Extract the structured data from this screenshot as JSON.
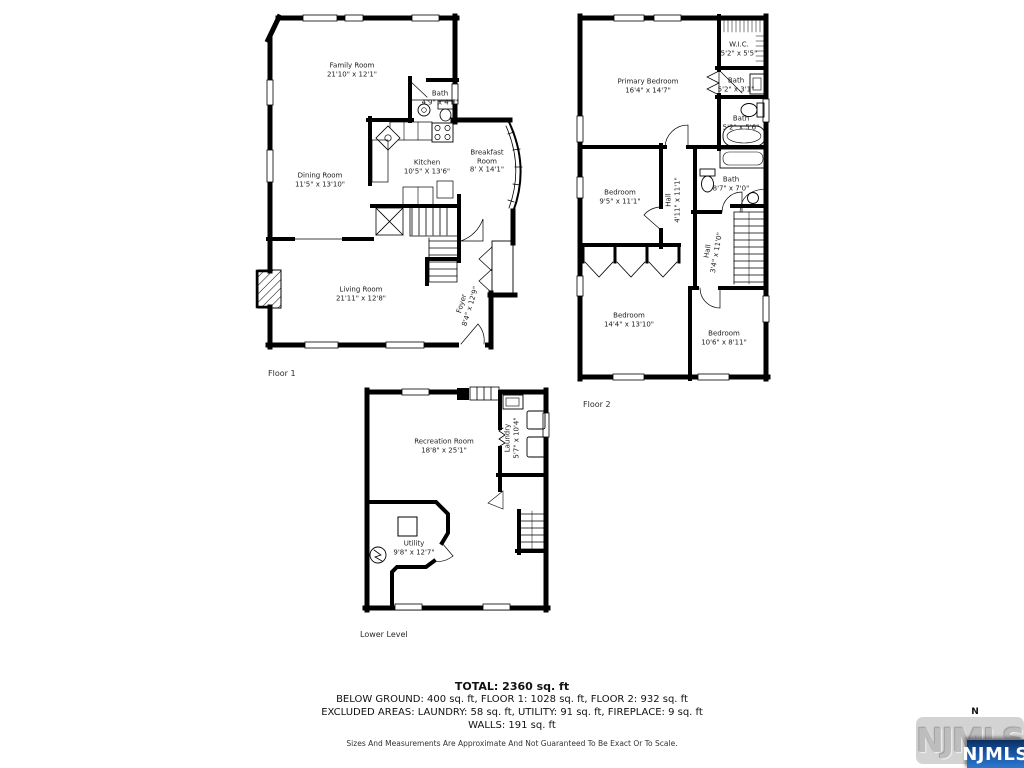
{
  "floors": {
    "floor1": {
      "label": "Floor 1",
      "rooms": {
        "family": {
          "name": "Family Room",
          "dims": "21'10\" x 12'1\""
        },
        "bath": {
          "name": "Bath",
          "dims": "4'9\" x 4'9\""
        },
        "kitchen": {
          "name": "Kitchen",
          "dims": "10'5\" X 13'6\""
        },
        "breakfast": {
          "name": "Breakfast Room",
          "dims": "8' X 14'1\""
        },
        "dining": {
          "name": "Dining Room",
          "dims": "11'5\" x 13'10\""
        },
        "living": {
          "name": "Living Room",
          "dims": "21'11\" x 12'8\""
        },
        "foyer": {
          "name": "Foyer",
          "dims": "8'4\" x 12'9\""
        }
      }
    },
    "floor2": {
      "label": "Floor 2",
      "rooms": {
        "primary": {
          "name": "Primary Bedroom",
          "dims": "16'4\" x 14'7\""
        },
        "wic": {
          "name": "W.I.C.",
          "dims": "5'2\" x 5'5\""
        },
        "bath_small": {
          "name": "Bath",
          "dims": "5'2\" x 3'1\""
        },
        "bath_mid": {
          "name": "Bath",
          "dims": "5'2\" x 5'6\""
        },
        "bedroom1": {
          "name": "Bedroom",
          "dims": "9'5\" x 11'1\""
        },
        "hall1": {
          "name": "Hall",
          "dims": "4'11\" x 11'1\""
        },
        "bath_large": {
          "name": "Bath",
          "dims": "8'7\" x 7'0\""
        },
        "hall2": {
          "name": "Hall",
          "dims": "3'4\" x 11'0\""
        },
        "bedroom2": {
          "name": "Bedroom",
          "dims": "14'4\" x 13'10\""
        },
        "bedroom3": {
          "name": "Bedroom",
          "dims": "10'6\" x 8'11\""
        }
      }
    },
    "lower": {
      "label": "Lower Level",
      "rooms": {
        "recreation": {
          "name": "Recreation Room",
          "dims": "18'8\" x 25'1\""
        },
        "laundry": {
          "name": "Laundry",
          "dims": "5'7\" x 10'4\""
        },
        "utility": {
          "name": "Utility",
          "dims": "9'8\" x 12'7\""
        }
      }
    }
  },
  "summary": {
    "total": "TOTAL: 2360 sq. ft",
    "line1": "BELOW GROUND: 400 sq. ft, FLOOR 1: 1028 sq. ft, FLOOR 2: 932 sq. ft",
    "line2": "EXCLUDED AREAS: LAUNDRY: 58 sq. ft, UTILITY: 91 sq. ft, FIREPLACE: 9 sq. ft",
    "line3": "WALLS: 191 sq. ft",
    "disclaimer": "Sizes And Measurements Are Approximate And Not Guaranteed To Be Exact Or To Scale."
  },
  "compass": {
    "north_label": "N"
  },
  "watermark": {
    "background_text": "NJMLS",
    "badge_text": "NJMLS",
    "badge_color": "#1a5cb0",
    "badge_text_color": "#ffffff",
    "wall_color": "#000000"
  }
}
